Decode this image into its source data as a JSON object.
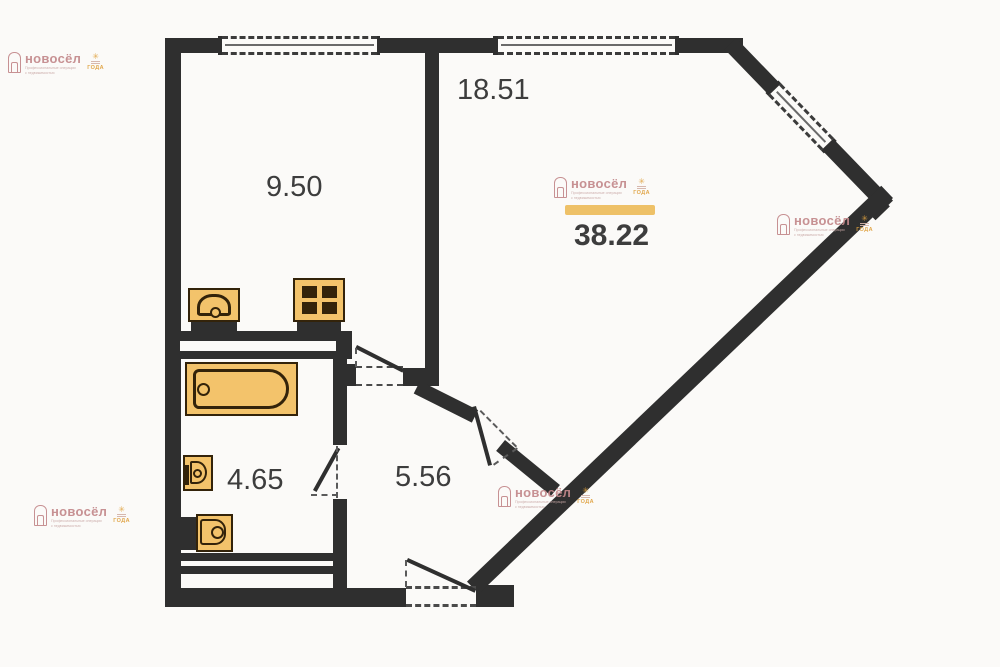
{
  "title": "apartment floor plan",
  "rooms": {
    "r1851": "18.51",
    "r950": "9.50",
    "r3822": "38.22",
    "r465": "4.65",
    "r556": "5.56"
  },
  "watermark": {
    "brand": "новосёл",
    "tagline1": "Профессиональные операции",
    "tagline2": "с недвижимостью",
    "badge_star": "✳",
    "badge_word": "ГОДА"
  },
  "icons": {
    "stove": "four-burner-stove",
    "sink": "kitchen-sink",
    "bathtub": "bathtub",
    "washbasin": "washbasin",
    "toilet": "toilet",
    "windows": "dashed-window-opening",
    "doors": "door-swing-arc"
  },
  "colors": {
    "wall": "#2f2f2f",
    "fix_fill": "#f3c36b",
    "fix_line": "#33230a",
    "accent": "#eec168",
    "wm_pink": "#c3898b",
    "wm_orange": "#dfa13f",
    "label": "#3d3d3d",
    "bg": "#fbfaf8"
  }
}
